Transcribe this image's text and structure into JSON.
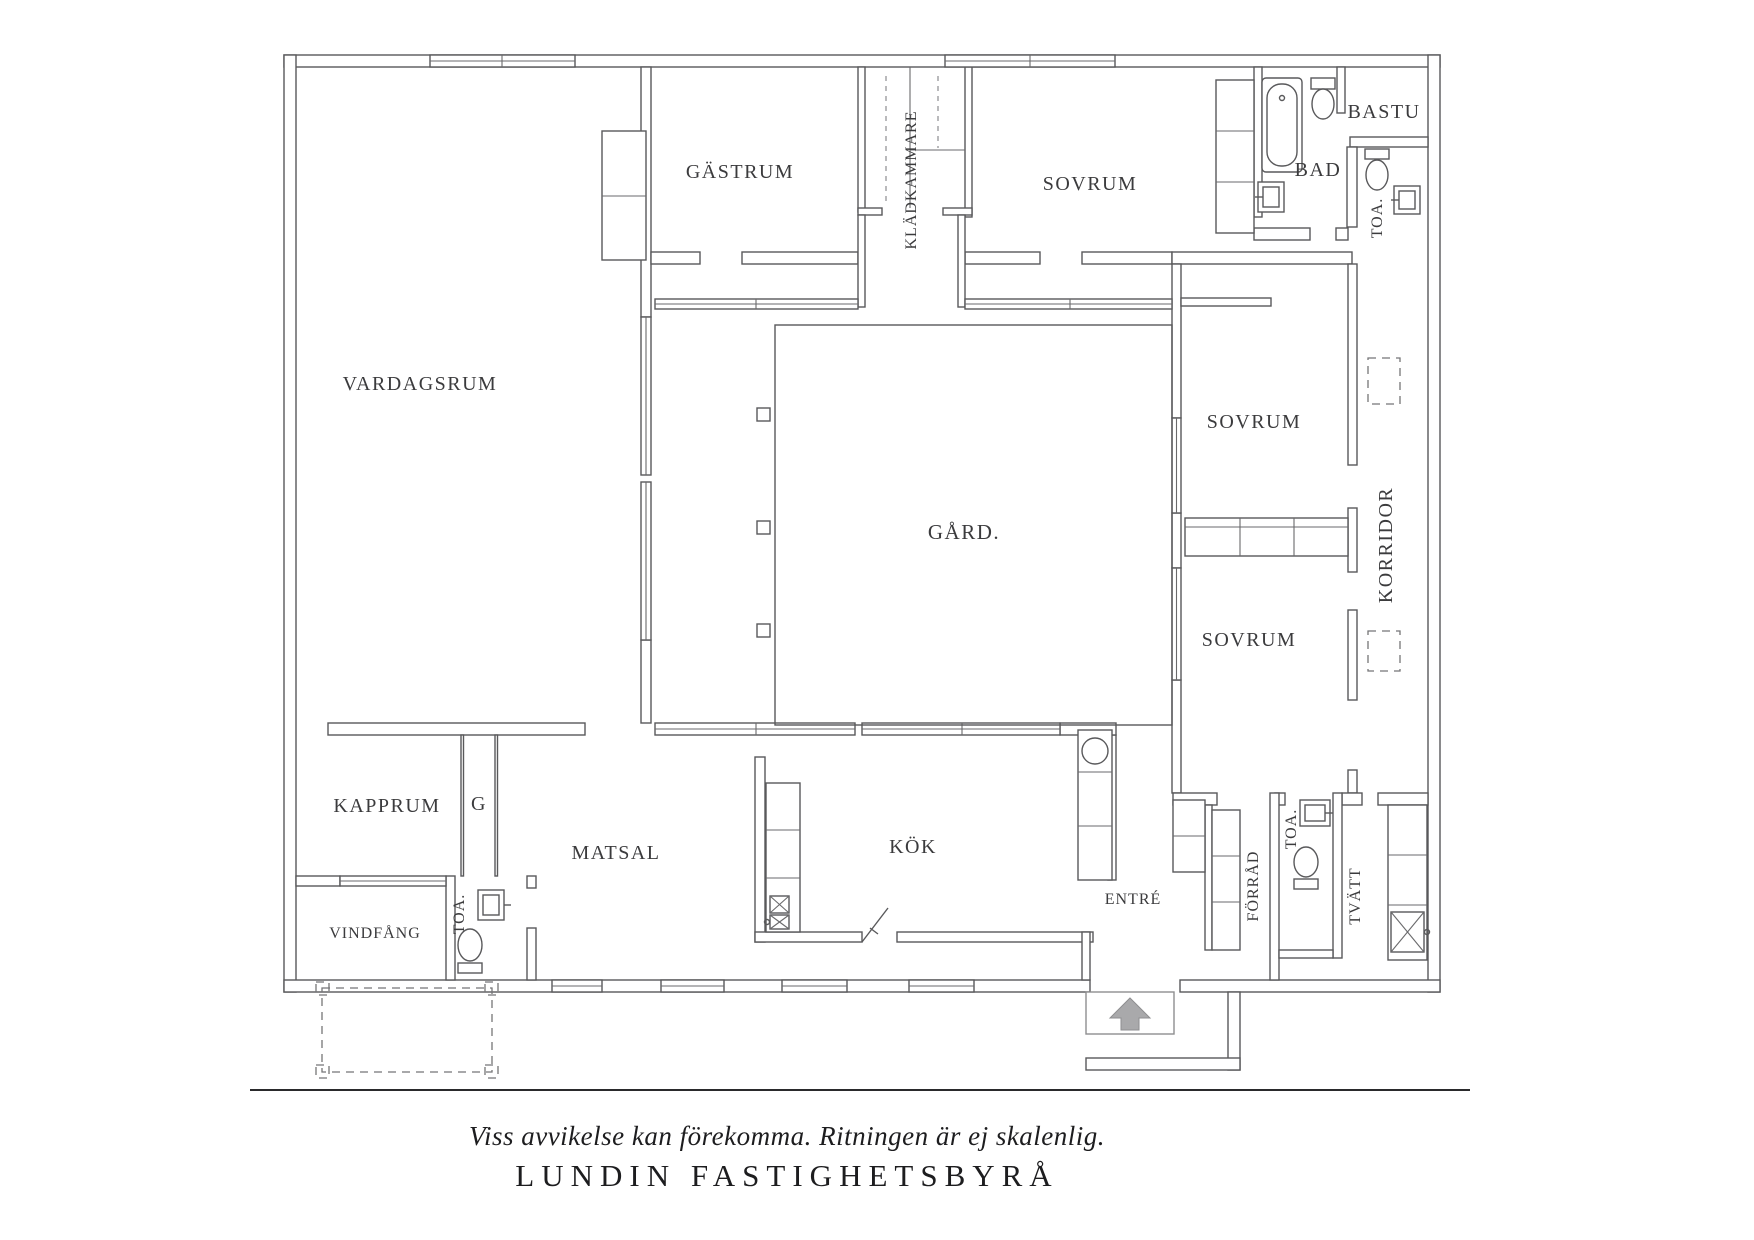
{
  "plan": {
    "line_color": "#59595b",
    "text_color": "#3b3b3d",
    "arrow_color": "#a9a9ab",
    "rooms": {
      "vardagsrum": "VARDAGSRUM",
      "gastrum": "GÄSTRUM",
      "kladkammare": "KLÄDKAMMARE",
      "sovrum_top": "SOVRUM",
      "bad": "BAD",
      "bastu": "BASTU",
      "toa_top": "TOA.",
      "gard": "GÅRD.",
      "sovrum_mid": "SOVRUM",
      "korridor": "KORRIDOR",
      "sovrum_low": "SOVRUM",
      "kapprum": "KAPPRUM",
      "g_closet": "G",
      "vindfang": "VINDFÅNG",
      "toa_left": "TOA.",
      "matsal": "MATSAL",
      "kok": "KÖK",
      "entre": "ENTRÉ",
      "forrad": "FÖRRÅD",
      "toa_right": "TOA.",
      "tvatt": "TVÄTT"
    }
  },
  "footer": {
    "disclaimer": "Viss avvikelse kan förekomma. Ritningen är ej skalenlig.",
    "brand": "LUNDIN FASTIGHETSBYRÅ"
  }
}
